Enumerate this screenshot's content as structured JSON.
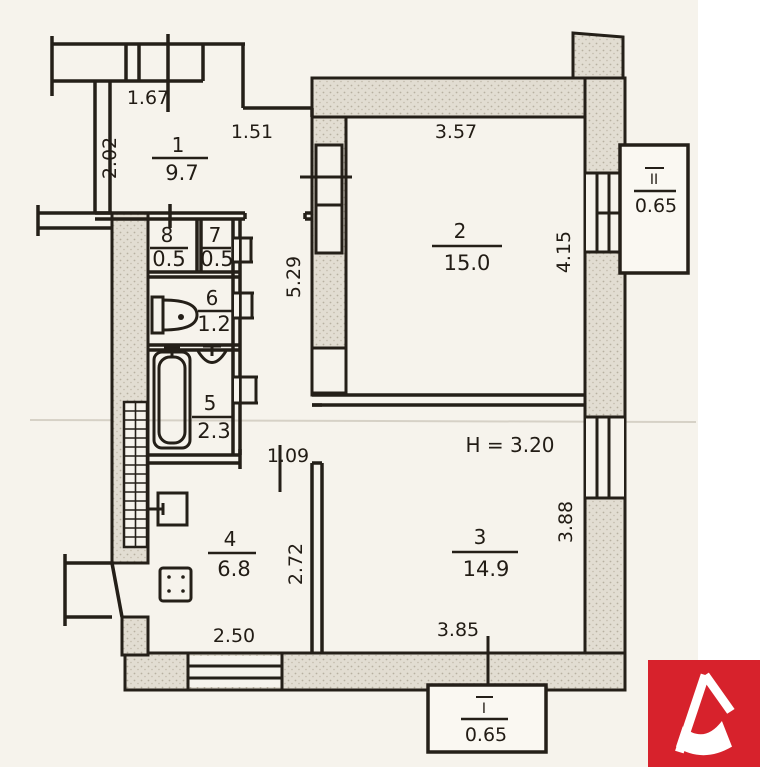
{
  "plan": {
    "ceiling_height_note": "H = 3.20",
    "rooms": {
      "r1": {
        "number": "1",
        "area": "9.7"
      },
      "r2": {
        "number": "2",
        "area": "15.0"
      },
      "r3": {
        "number": "3",
        "area": "14.9"
      },
      "r4": {
        "number": "4",
        "area": "6.8"
      },
      "r5": {
        "number": "5",
        "area": "2.3"
      },
      "r6": {
        "number": "6",
        "area": "1.2"
      },
      "r7": {
        "number": "7",
        "area": "0.5"
      },
      "r8": {
        "number": "8",
        "area": "0.5"
      }
    },
    "balconies": {
      "b1": {
        "number": "I",
        "area": "0.65"
      },
      "b2": {
        "number": "II",
        "area": "0.65"
      }
    },
    "dimensions": {
      "d167": "1.67",
      "d202": "2.02",
      "d151": "1.51",
      "d357": "3.57",
      "d415": "4.15",
      "d529": "5.29",
      "d109": "1.09",
      "d272": "2.72",
      "d250": "2.50",
      "d385": "3.85",
      "d388": "3.88"
    }
  },
  "colors": {
    "paper": "#f6f3ec",
    "ink": "#241f18",
    "wall_fill": "#e2ddd2",
    "logo_red": "#d7222c"
  }
}
